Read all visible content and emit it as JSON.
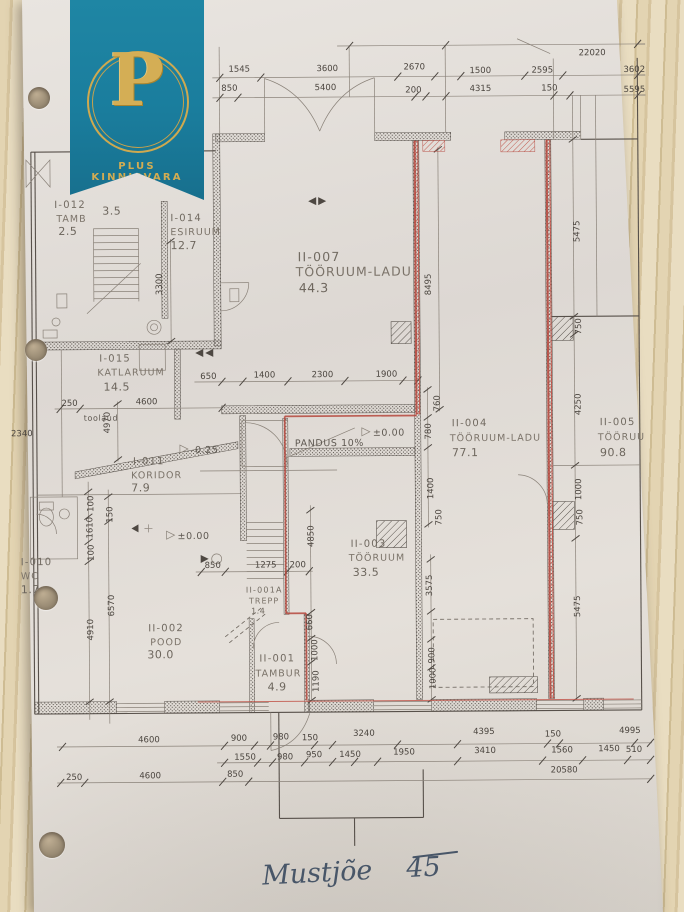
{
  "logo": {
    "letter": "P",
    "brand": "PLUS KINNISVARA"
  },
  "colors": {
    "brand_teal": "#1a7d9d",
    "brand_gold": "#cfa94f",
    "highlight_red": "#b5463c"
  },
  "plan": {
    "rooms": {
      "i012": {
        "id": "I-012",
        "name": "TAMB",
        "area": "2.5"
      },
      "trepp_area": "3.5",
      "i014": {
        "id": "I-014",
        "name": "ESIRUUM",
        "area": "12.7"
      },
      "i015": {
        "id": "I-015",
        "name": "KATLARUUM",
        "area": "14.5"
      },
      "i011": {
        "id": "I-011",
        "name": "KORIDOR",
        "area": "7.9"
      },
      "i010": {
        "id": "I-010",
        "name": "WC",
        "area": "1.7"
      },
      "ii007": {
        "id": "II-007",
        "name": "TÖÖRUUM-LADU",
        "area": "44.3"
      },
      "ii004": {
        "id": "II-004",
        "name": "TÖÖRUUM-LADU",
        "area": "77.1"
      },
      "ii005": {
        "id": "II-005",
        "name": "TÖÖRUU",
        "area": "90.8"
      },
      "ii003": {
        "id": "II-003",
        "name": "TÖÖRUUM",
        "area": "33.5"
      },
      "ii002": {
        "id": "II-002",
        "name": "POOD",
        "area": "30.0"
      },
      "ii001a": {
        "id": "II-001A",
        "name": "TREPP",
        "area": "1.4"
      },
      "ii001": {
        "id": "II-001",
        "name": "TAMBUR",
        "area": "4.9"
      }
    },
    "annotations": {
      "pandus": "PANDUS 10%",
      "level_zero": "±0.00",
      "level_minus": "-0.25",
      "bench": "toolaud"
    },
    "dims": {
      "top": [
        "22020",
        "1545",
        "3600",
        "2670",
        "1500",
        "2595",
        "3602",
        "850",
        "5400",
        "200",
        "4315",
        "150",
        "5595"
      ],
      "mid": [
        "650",
        "1400",
        "2300",
        "1900",
        "250",
        "4600",
        "850",
        "1275",
        "200"
      ],
      "left": [
        "2340",
        "100",
        "1610",
        "100",
        "150",
        "6570",
        "4910",
        "4970",
        "3300"
      ],
      "center": [
        "8495",
        "4850",
        "660",
        "1000",
        "1190",
        "3575",
        "900",
        "1000",
        "760",
        "780",
        "1400",
        "750"
      ],
      "right": [
        "5475",
        "750",
        "4250",
        "1000",
        "750",
        "5475"
      ],
      "bottom": [
        "4600",
        "900",
        "980",
        "150",
        "3240",
        "4395",
        "150",
        "4995",
        "1550",
        "980",
        "950",
        "1450",
        "1950",
        "3410",
        "1560",
        "1450",
        "510",
        "250",
        "4600",
        "850",
        "20580"
      ]
    }
  },
  "handwriting": {
    "street": "Mustjõe",
    "number": "45"
  }
}
